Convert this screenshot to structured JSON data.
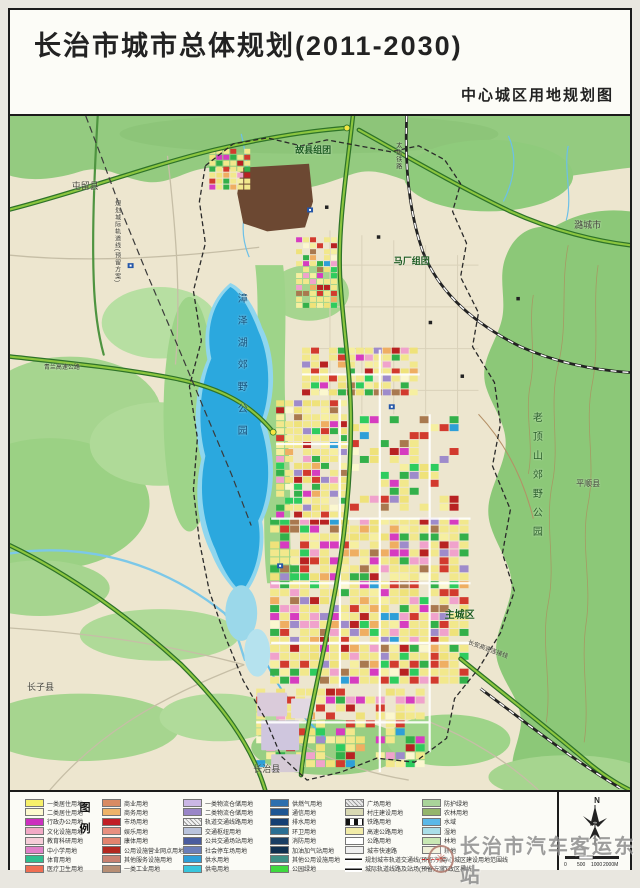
{
  "page": {
    "title": "长治市城市总体规划(2011-2030)",
    "subtitle": "中心城区用地规划图"
  },
  "map": {
    "labels": [
      {
        "id": "tunliu-county",
        "text": "屯留县",
        "x": 62,
        "y": 66,
        "size": 9,
        "color": "#45453d"
      },
      {
        "id": "guxian-cluster",
        "text": "故县组团",
        "x": 286,
        "y": 30,
        "size": 9,
        "color": "#1d5c22",
        "bold": true
      },
      {
        "id": "machang-cluster",
        "text": "马厂组团",
        "x": 385,
        "y": 142,
        "size": 9,
        "color": "#1d5c22",
        "bold": true
      },
      {
        "id": "lucheng-city",
        "text": "潞城市",
        "x": 566,
        "y": 106,
        "size": 9,
        "color": "#45453d"
      },
      {
        "id": "zhangze-lake-park",
        "text": "漳泽湖郊野公园",
        "x": 226,
        "y": 178,
        "size": 10,
        "color": "#14507a",
        "vertical": true,
        "spacing": 12
      },
      {
        "id": "laodingshan-park",
        "text": "老顶山郊野公园",
        "x": 522,
        "y": 298,
        "size": 10,
        "color": "#2a5e2a",
        "vertical": true,
        "spacing": 9
      },
      {
        "id": "pingshun-county",
        "text": "平顺县",
        "x": 568,
        "y": 366,
        "size": 8,
        "color": "#45453d"
      },
      {
        "id": "main-city-zone",
        "text": "主城区",
        "x": 436,
        "y": 498,
        "size": 10,
        "color": "#1d5c22",
        "bold": true
      },
      {
        "id": "changzi-county",
        "text": "长子县",
        "x": 17,
        "y": 570,
        "size": 9,
        "color": "#45453d"
      },
      {
        "id": "changzhi-county",
        "text": "长治县",
        "x": 244,
        "y": 653,
        "size": 9,
        "color": "#45453d"
      },
      {
        "id": "qinglan-expressway",
        "text": "青兰高速公路",
        "x": 34,
        "y": 250,
        "size": 6,
        "color": "#3a3a33"
      },
      {
        "id": "taijiao-railway",
        "text": "太焦铁路",
        "x": 386,
        "y": 26,
        "size": 6,
        "color": "#3a3a33",
        "vertical": true,
        "spacing": 1
      },
      {
        "id": "changan-connector",
        "text": "长安高速连接线",
        "x": 460,
        "y": 527,
        "size": 6,
        "color": "#3a3a33",
        "rotate": 20
      },
      {
        "id": "reserved-rail-line",
        "text": "规划城际轨道线(预留方案)",
        "x": 104,
        "y": 84,
        "size": 6,
        "color": "#3a3a33",
        "vertical": true,
        "spacing": 1
      }
    ]
  },
  "legend": {
    "title_chars": [
      "图",
      "例"
    ],
    "columns": [
      {
        "items": [
          {
            "t": "一类居住用地",
            "c": "#F7F06A"
          },
          {
            "t": "二类居住用地",
            "c": "#FCF9CF"
          },
          {
            "t": "行政办公用地",
            "c": "#CC2FBE"
          },
          {
            "t": "文化设施用地",
            "c": "#F2AAC6"
          },
          {
            "t": "教育科研用地",
            "c": "#F6CDD8"
          },
          {
            "t": "中小学用地",
            "c": "#E080C8"
          },
          {
            "t": "体育用地",
            "c": "#2FBF8F"
          },
          {
            "t": "医疗卫生用地",
            "c": "#EF6E52"
          }
        ]
      },
      {
        "items": [
          {
            "t": "商业用地",
            "c": "#D98B63"
          },
          {
            "t": "商务用地",
            "c": "#EEB369"
          },
          {
            "t": "市场用地",
            "c": "#C11E26"
          },
          {
            "t": "娱乐用地",
            "c": "#E89080"
          },
          {
            "t": "康体用地",
            "c": "#E2836E"
          },
          {
            "t": "公用设施营业网点用地",
            "c": "#B3271F"
          },
          {
            "t": "其他服务设施用地",
            "c": "#C98070"
          },
          {
            "t": "一类工业用地",
            "c": "#B78E74"
          }
        ]
      },
      {
        "items": [
          {
            "t": "一类物流仓储用地",
            "c": "#CBB7E5"
          },
          {
            "t": "二类物流仓储用地",
            "c": "#9A86C8"
          },
          {
            "t": "轨道交通线路用地",
            "c": "#F2F2F2",
            "s": "hatch"
          },
          {
            "t": "交通枢纽用地",
            "c": "#B9C3DC"
          },
          {
            "t": "公共交通场站用地",
            "c": "#4A5C9E"
          },
          {
            "t": "社会停车场用地",
            "c": "#6B7EB8"
          },
          {
            "t": "供水用地",
            "c": "#2E9FD8"
          },
          {
            "t": "供电用地",
            "c": "#38C5DC"
          }
        ]
      },
      {
        "items": [
          {
            "t": "供燃气用地",
            "c": "#2D6FAE"
          },
          {
            "t": "通信用地",
            "c": "#1F5693"
          },
          {
            "t": "排水用地",
            "c": "#153F73"
          },
          {
            "t": "环卫用地",
            "c": "#2B6F93"
          },
          {
            "t": "消防用地",
            "c": "#1A3E63"
          },
          {
            "t": "加油加气站用地",
            "c": "#10304F"
          },
          {
            "t": "其他公用设施用地",
            "c": "#3E8F84"
          },
          {
            "t": "公园绿地",
            "c": "#3FD93F"
          }
        ]
      },
      {
        "items": [
          {
            "t": "广场用地",
            "c": "#E9E9E9",
            "s": "hatch"
          },
          {
            "t": "村庄建设用地",
            "c": "#D9D9B3"
          },
          {
            "t": "铁路用地",
            "c": "#222222",
            "s": "rail"
          },
          {
            "t": "高速公路用地",
            "c": "#F2ECA8"
          },
          {
            "t": "公路用地",
            "c": "#FFFFFF"
          },
          {
            "t": "城市快速路",
            "c": "#EFEFEF"
          },
          {
            "t": "规划城市轨道交通线(预留方案)",
            "c": "#333333",
            "s": "arrow"
          },
          {
            "t": "城际轨道线路及站场(预留方案)",
            "c": "#333333",
            "s": "arrow"
          }
        ]
      },
      {
        "items": [
          {
            "t": "防护绿地",
            "c": "#A9D39A"
          },
          {
            "t": "农林用地",
            "c": "#94B56B"
          },
          {
            "t": "水域",
            "c": "#5BB8E8"
          },
          {
            "t": "湿地",
            "c": "#AADEE8"
          },
          {
            "t": "林地",
            "c": "#C9E8B4"
          },
          {
            "t": "耕地",
            "c": "#EFEFD8"
          },
          {
            "t": "中心城区建设用地范围线",
            "c": "#D02020",
            "s": "dash"
          },
          {
            "t": "行政区界线",
            "c": "#555555",
            "s": "dashdot"
          }
        ]
      }
    ]
  },
  "compass": {
    "north_label": "N"
  },
  "scalebar": {
    "labels": [
      "0",
      "500",
      "1000",
      "2000M"
    ]
  },
  "watermark": {
    "text": "长治市汽车客运东站",
    "logo_glyph": "✳"
  }
}
